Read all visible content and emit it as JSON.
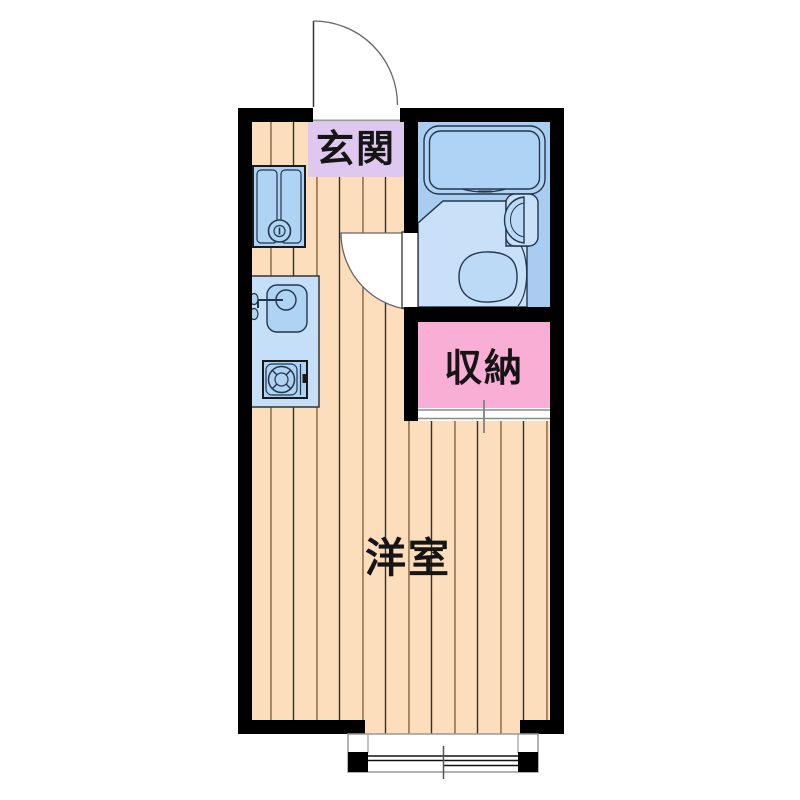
{
  "plan": {
    "type": "apartment-floorplan",
    "rooms": {
      "entrance": {
        "label": "玄関"
      },
      "storage": {
        "label": "収納"
      },
      "main_room": {
        "label": "洋室"
      }
    },
    "fixtures": [
      "bathtub",
      "washbasin",
      "toilet",
      "washing-machine",
      "kitchen-sink",
      "faucet",
      "gas-stove",
      "entrance-swing-door",
      "bathroom-swing-door",
      "closet-sliding-door",
      "sliding-window"
    ],
    "colors": {
      "wall": "#000000",
      "floor_tan": "#FCDEBD",
      "floor_line_brown": "#A5835E",
      "floor_line_dark": "#3A2E20",
      "entrance_lavender": "#DFC8EF",
      "storage_pink": "#F9AED5",
      "bath_blue": "#A8CDF0",
      "bath_floor_blue": "#C9E1F8",
      "fixture_blue": "#AED3F3",
      "fixture_blue_light": "#BCD9F6",
      "counter_blue": "#C5DFF8",
      "tub_blue": "#AFD3F4",
      "outline_navy": "#23364E",
      "door_line_gray": "#666666",
      "sash_gray": "#999999",
      "label_black": "#151515"
    }
  }
}
